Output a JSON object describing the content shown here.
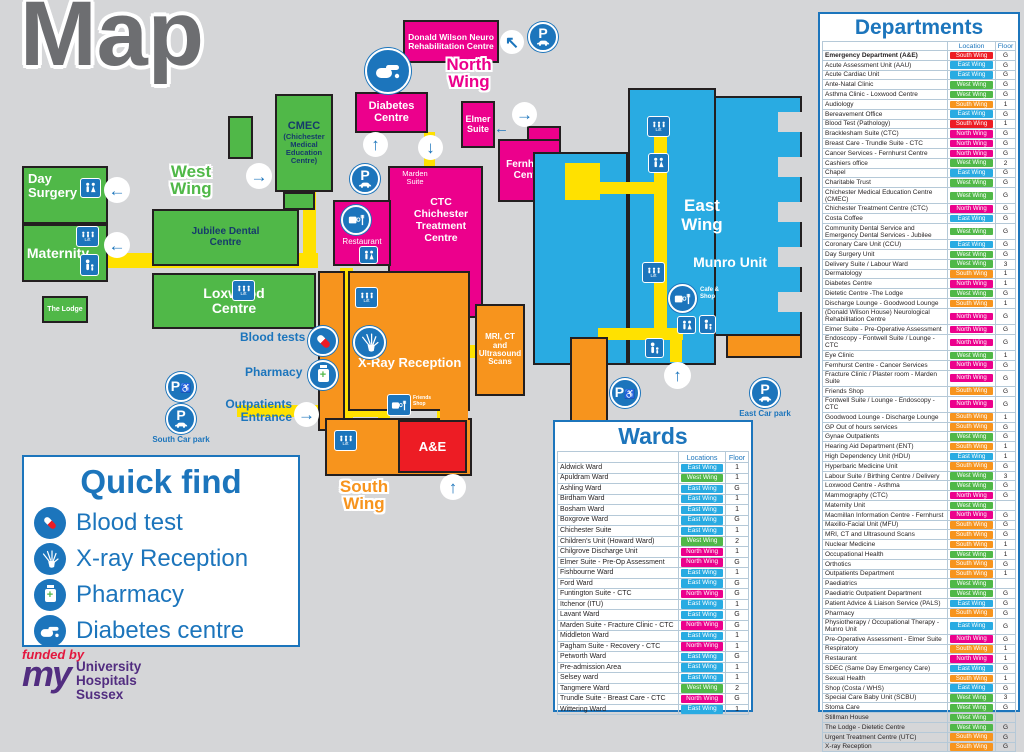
{
  "title": "Map",
  "colors": {
    "accent_blue": "#1c75bc",
    "east_wing": "#29abe2",
    "west_wing": "#50b848",
    "north_wing": "#ec008c",
    "south_wing": "#f7941d",
    "emergency_red": "#ed1c24",
    "corridor_yellow": "#ffe100",
    "background": "#d5d6d8"
  },
  "wing_styles": {
    "e": {
      "label": "East Wing",
      "color": "#29abe2"
    },
    "w": {
      "label": "West Wing",
      "color": "#50b848"
    },
    "n": {
      "label": "North Wing",
      "color": "#ec008c"
    },
    "s": {
      "label": "South Wing",
      "color": "#f7941d"
    },
    "r": {
      "label": "South Wing",
      "color": "#ed1c24"
    }
  },
  "map": {
    "labels": {
      "west_wing": "West Wing",
      "north_wing": "North Wing",
      "south_wing": "South Wing",
      "east_wing": "East Wing",
      "munro": "Munro Unit",
      "day_surgery": "Day Surgery",
      "maternity": "Maternity",
      "the_lodge": "The Lodge",
      "jubilee": "Jubilee Dental Centre",
      "loxwood": "Loxwood Centre",
      "cmec_main": "CMEC",
      "cmec_sub": "(Chichester Medical Education Centre)",
      "donald_wilson": "Donald Wilson Neuro Rehabilitation Centre",
      "diabetes": "Diabetes Centre",
      "elmer": "Elmer Suite",
      "fernhurst": "Fernhurst Centre",
      "marden": "Marden Suite",
      "ctc": "CTC Chichester Treatment Centre",
      "restaurant": "Restaurant",
      "xray": "X-Ray Reception",
      "ae": "A&E",
      "mri": "MRI, CT and Ultrasound Scans",
      "blood_tests": "Blood tests",
      "pharmacy": "Pharmacy",
      "outpatients": "Outpatients Entrance",
      "friends_shop": "Friends Shop",
      "cafe_shop": "Cafe & Shop",
      "south_car_park": "South Car park",
      "east_car_park": "East Car park",
      "lift": "Lift"
    }
  },
  "quick_find": {
    "title": "Quick find",
    "items": [
      {
        "icon": "blood-test-icon",
        "label": "Blood test"
      },
      {
        "icon": "xray-icon",
        "label": "X-ray Reception"
      },
      {
        "icon": "pharmacy-icon",
        "label": "Pharmacy"
      },
      {
        "icon": "diabetes-icon",
        "label": "Diabetes centre"
      }
    ]
  },
  "funded": {
    "funded_by": "funded by",
    "logo_my": "my",
    "org": "University\nHospitals\nSussex"
  },
  "wards_panel": {
    "title": "Wards",
    "col_location": "Locations",
    "col_floor": "Floor",
    "rows": [
      {
        "n": "Aldwick Ward",
        "w": "e",
        "f": "1"
      },
      {
        "n": "Apuldram Ward",
        "w": "w",
        "f": "1"
      },
      {
        "n": "Ashling Ward",
        "w": "e",
        "f": "G"
      },
      {
        "n": "Birdham Ward",
        "w": "e",
        "f": "1"
      },
      {
        "n": "Bosham Ward",
        "w": "e",
        "f": "1"
      },
      {
        "n": "Boxgrove Ward",
        "w": "e",
        "f": "G"
      },
      {
        "n": "Chichester Suite",
        "w": "e",
        "f": "1"
      },
      {
        "n": "Children's Unit (Howard Ward)",
        "w": "w",
        "f": "2"
      },
      {
        "n": "Chilgrove Discharge Unit",
        "w": "n",
        "f": "1"
      },
      {
        "n": "Elmer Suite - Pre-Op Assessment",
        "w": "n",
        "f": "G"
      },
      {
        "n": "Fishbourne Ward",
        "w": "e",
        "f": "1"
      },
      {
        "n": "Ford Ward",
        "w": "e",
        "f": "G"
      },
      {
        "n": "Funtington Suite - CTC",
        "w": "n",
        "f": "G"
      },
      {
        "n": "Itchenor (ITU)",
        "w": "e",
        "f": "1"
      },
      {
        "n": "Lavant Ward",
        "w": "e",
        "f": "G"
      },
      {
        "n": "Marden Suite - Fracture Clinic - CTC",
        "w": "n",
        "f": "G"
      },
      {
        "n": "Middleton Ward",
        "w": "e",
        "f": "1"
      },
      {
        "n": "Pagham Suite - Recovery - CTC",
        "w": "n",
        "f": "1"
      },
      {
        "n": "Petworth Ward",
        "w": "e",
        "f": "G"
      },
      {
        "n": "Pre-admission Area",
        "w": "e",
        "f": "1"
      },
      {
        "n": "Selsey ward",
        "w": "e",
        "f": "1"
      },
      {
        "n": "Tangmere Ward",
        "w": "w",
        "f": "2"
      },
      {
        "n": "Trundle Suite - Breast Care - CTC",
        "w": "n",
        "f": "G"
      },
      {
        "n": "Wittering Ward",
        "w": "e",
        "f": "1"
      }
    ]
  },
  "departments_panel": {
    "title": "Departments",
    "col_location": "Location",
    "col_floor": "Floor",
    "rows": [
      {
        "n": "Emergency Department (A&E)",
        "w": "r",
        "f": "G",
        "hl": true
      },
      {
        "n": "Acute Assessment Unit (AAU)",
        "w": "e",
        "f": "G"
      },
      {
        "n": "Acute Cardiac Unit",
        "w": "e",
        "f": "G"
      },
      {
        "n": "Ante-Natal Clinic",
        "w": "w",
        "f": "G"
      },
      {
        "n": "Asthma Clinic - Loxwood Centre",
        "w": "w",
        "f": "G"
      },
      {
        "n": "Audiology",
        "w": "s",
        "f": "1"
      },
      {
        "n": "Bereavement Office",
        "w": "e",
        "f": "G"
      },
      {
        "n": "Blood Test (Pathology)",
        "w": "r",
        "f": "1"
      },
      {
        "n": "Bracklesham Suite (CTC)",
        "w": "n",
        "f": "G"
      },
      {
        "n": "Breast Care - Trundle Suite - CTC",
        "w": "n",
        "f": "G"
      },
      {
        "n": "Cancer Services - Fernhurst Centre",
        "w": "n",
        "f": "G"
      },
      {
        "n": "Cashiers office",
        "w": "w",
        "f": "2"
      },
      {
        "n": "Chapel",
        "w": "e",
        "f": "G"
      },
      {
        "n": "Charitable Trust",
        "w": "w",
        "f": "G"
      },
      {
        "n": "Chichester Medical Education Centre (CMEC)",
        "w": "w",
        "f": "G"
      },
      {
        "n": "Chichester Treatment Centre (CTC)",
        "w": "n",
        "f": "G"
      },
      {
        "n": "Costa Coffee",
        "w": "e",
        "f": "G"
      },
      {
        "n": "Community Dental Service and Emergency Dental Services - Jubilee",
        "w": "w",
        "f": "G"
      },
      {
        "n": "Coronary Care Unit (CCU)",
        "w": "e",
        "f": "G"
      },
      {
        "n": "Day Surgery Unit",
        "w": "w",
        "f": "G"
      },
      {
        "n": "Delivery Suite / Labour Ward",
        "w": "w",
        "f": "3"
      },
      {
        "n": "Dermatology",
        "w": "s",
        "f": "1"
      },
      {
        "n": "Diabetes Centre",
        "w": "n",
        "f": "1"
      },
      {
        "n": "Dietetic Centre -The Lodge",
        "w": "w",
        "f": "G"
      },
      {
        "n": "Discharge Lounge - Goodwood Lounge",
        "w": "s",
        "f": "1"
      },
      {
        "n": "(Donald Wilson House) Neurological Rehabilitation Centre",
        "w": "n",
        "f": "G"
      },
      {
        "n": "Elmer Suite - Pre-Operative Assessment",
        "w": "n",
        "f": "G"
      },
      {
        "n": "Endoscopy - Fontwell Suite / Lounge - CTC",
        "w": "n",
        "f": "G"
      },
      {
        "n": "Eye Clinic",
        "w": "w",
        "f": "1"
      },
      {
        "n": "Fernhurst Centre - Cancer Services",
        "w": "n",
        "f": "G"
      },
      {
        "n": "Fracture Clinic / Plaster room - Marden Suite",
        "w": "n",
        "f": "G"
      },
      {
        "n": "Friends Shop",
        "w": "s",
        "f": "G"
      },
      {
        "n": "Fontwell Suite / Lounge - Endoscopy - CTC",
        "w": "n",
        "f": "G"
      },
      {
        "n": "Goodwood Lounge - Discharge Lounge",
        "w": "s",
        "f": "1"
      },
      {
        "n": "GP Out of hours services",
        "w": "s",
        "f": "G"
      },
      {
        "n": "Gynae Outpatients",
        "w": "w",
        "f": "G"
      },
      {
        "n": "Hearing Aid Department (ENT)",
        "w": "s",
        "f": "1"
      },
      {
        "n": "High Dependency Unit (HDU)",
        "w": "e",
        "f": "1"
      },
      {
        "n": "Hyperbaric Medicine Unit",
        "w": "s",
        "f": "G"
      },
      {
        "n": "Labour Suite / Birthing Centre / Delivery",
        "w": "w",
        "f": "3"
      },
      {
        "n": "Loxwood Centre - Asthma",
        "w": "w",
        "f": "G"
      },
      {
        "n": "Mammography (CTC)",
        "w": "n",
        "f": "G"
      },
      {
        "n": "Maternity Unit",
        "w": "w",
        "f": ""
      },
      {
        "n": "Macmillan Information Centre - Fernhurst",
        "w": "n",
        "f": "G"
      },
      {
        "n": "Maxillo-Facial Unit (MFU)",
        "w": "s",
        "f": "G"
      },
      {
        "n": "MRI, CT and Ultrasound Scans",
        "w": "s",
        "f": "G"
      },
      {
        "n": "Nuclear Medicine",
        "w": "s",
        "f": "1"
      },
      {
        "n": "Occupational Health",
        "w": "w",
        "f": "1"
      },
      {
        "n": "Orthotics",
        "w": "s",
        "f": "G"
      },
      {
        "n": "Outpatients Department",
        "w": "s",
        "f": "1"
      },
      {
        "n": "Paediatrics",
        "w": "w",
        "f": ""
      },
      {
        "n": "Paediatric Outpatient Department",
        "w": "w",
        "f": "G"
      },
      {
        "n": "Patient Advice & Liaison Service (PALS)",
        "w": "e",
        "f": "G"
      },
      {
        "n": "Pharmacy",
        "w": "s",
        "f": "G"
      },
      {
        "n": "Physiotherapy / Occupational Therapy - Munro Unit",
        "w": "e",
        "f": "G"
      },
      {
        "n": "Pre-Operative Assessment -  Elmer Suite",
        "w": "n",
        "f": "G"
      },
      {
        "n": "Respiratory",
        "w": "s",
        "f": "1"
      },
      {
        "n": "Restaurant",
        "w": "n",
        "f": "1"
      },
      {
        "n": "SDEC (Same Day Emergency Care)",
        "w": "e",
        "f": "G"
      },
      {
        "n": "Sexual Health",
        "w": "s",
        "f": "1"
      },
      {
        "n": "Shop (Costa / WHS)",
        "w": "e",
        "f": "G"
      },
      {
        "n": "Special Care Baby Unit  (SCBU)",
        "w": "w",
        "f": "3"
      },
      {
        "n": "Stoma Care",
        "w": "w",
        "f": "G"
      },
      {
        "n": "Stillman House",
        "w": "w",
        "f": ""
      },
      {
        "n": "The Lodge - Dietetic Centre",
        "w": "w",
        "f": "G"
      },
      {
        "n": "Urgent Treatment Centre (UTC)",
        "w": "s",
        "f": "G"
      },
      {
        "n": "X-ray Reception",
        "w": "s",
        "f": "G"
      }
    ]
  }
}
